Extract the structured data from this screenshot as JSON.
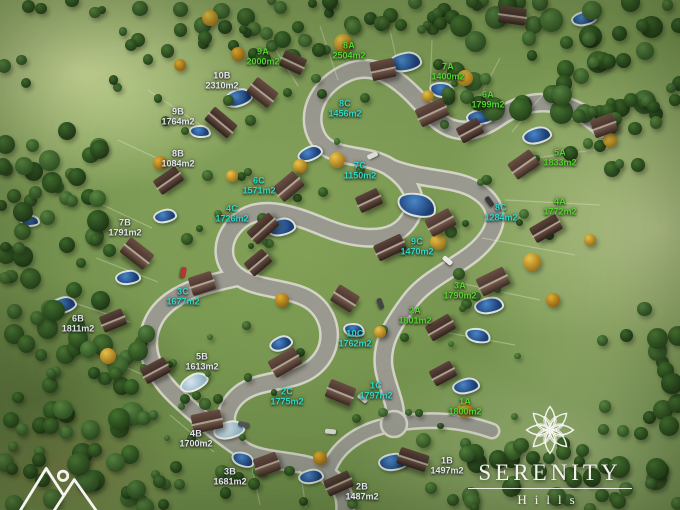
{
  "title": "Serenity Hills master plan",
  "branding": {
    "name": "SERENITY",
    "subname": "Hills",
    "icon": "lotus-mandala-icon"
  },
  "corner_mark": {
    "icon": "mountains-sun-icon"
  },
  "area_unit": "m2",
  "label_colors": {
    "A": "#54d42e",
    "B": "#e2e5ee",
    "C": "#2ed9cb"
  },
  "lots": [
    {
      "id": "9A",
      "area": "2000",
      "g": "A",
      "x": 263,
      "y": 57
    },
    {
      "id": "8A",
      "area": "2504",
      "g": "A",
      "x": 349,
      "y": 51
    },
    {
      "id": "10B",
      "area": "2310",
      "g": "B",
      "x": 222,
      "y": 81
    },
    {
      "id": "7A",
      "area": "1400",
      "g": "A",
      "x": 448,
      "y": 72
    },
    {
      "id": "6A",
      "area": "1799",
      "g": "A",
      "x": 488,
      "y": 100
    },
    {
      "id": "9B",
      "area": "1764",
      "g": "B",
      "x": 178,
      "y": 117
    },
    {
      "id": "8C",
      "area": "1456",
      "g": "C",
      "x": 345,
      "y": 109
    },
    {
      "id": "8B",
      "area": "1084",
      "g": "B",
      "x": 178,
      "y": 159
    },
    {
      "id": "7C",
      "area": "1150",
      "g": "C",
      "x": 360,
      "y": 171
    },
    {
      "id": "5A",
      "area": "1833",
      "g": "A",
      "x": 560,
      "y": 158
    },
    {
      "id": "6C",
      "area": "1571",
      "g": "C",
      "x": 259,
      "y": 186
    },
    {
      "id": "4C",
      "area": "1726",
      "g": "C",
      "x": 232,
      "y": 214
    },
    {
      "id": "8C",
      "area": "1284",
      "g": "C",
      "x": 501,
      "y": 213
    },
    {
      "id": "4A",
      "area": "1772",
      "g": "A",
      "x": 560,
      "y": 207
    },
    {
      "id": "7B",
      "area": "1791",
      "g": "B",
      "x": 125,
      "y": 228
    },
    {
      "id": "9C",
      "area": "1470",
      "g": "C",
      "x": 417,
      "y": 247
    },
    {
      "id": "3A",
      "area": "1790",
      "g": "A",
      "x": 460,
      "y": 291
    },
    {
      "id": "3C",
      "area": "1677",
      "g": "C",
      "x": 183,
      "y": 297
    },
    {
      "id": "2A",
      "area": "1801",
      "g": "A",
      "x": 415,
      "y": 316
    },
    {
      "id": "6B",
      "area": "1811",
      "g": "B",
      "x": 78,
      "y": 324
    },
    {
      "id": "10C",
      "area": "1762",
      "g": "C",
      "x": 355,
      "y": 339
    },
    {
      "id": "5B",
      "area": "1613",
      "g": "B",
      "x": 202,
      "y": 362
    },
    {
      "id": "2C",
      "area": "1775",
      "g": "C",
      "x": 287,
      "y": 397
    },
    {
      "id": "1C",
      "area": "1797",
      "g": "C",
      "x": 376,
      "y": 391
    },
    {
      "id": "1A",
      "area": "1800",
      "g": "A",
      "x": 465,
      "y": 407
    },
    {
      "id": "4B",
      "area": "1700",
      "g": "B",
      "x": 196,
      "y": 439
    },
    {
      "id": "1B",
      "area": "1497",
      "g": "B",
      "x": 447,
      "y": 466
    },
    {
      "id": "3B",
      "area": "1681",
      "g": "B",
      "x": 230,
      "y": 477
    },
    {
      "id": "2B",
      "area": "1487",
      "g": "B",
      "x": 362,
      "y": 492
    }
  ]
}
